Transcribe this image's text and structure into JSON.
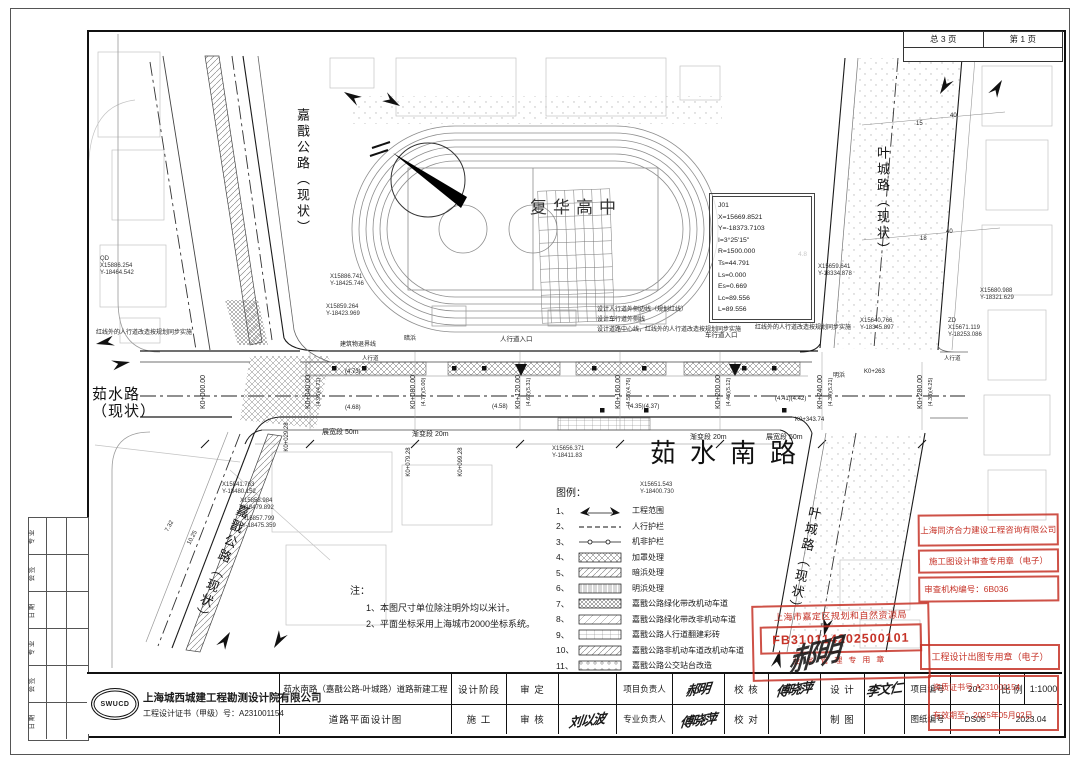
{
  "colors": {
    "stamp_red": "#c63227",
    "line_dark": "#1b1b1b"
  },
  "page": {
    "sheet_total": "总 3 页",
    "sheet_no": "第 1 页"
  },
  "roads": {
    "main": "茹水南路",
    "school": "复华高中",
    "jiajian": "嘉戬公路（现状）",
    "yecheng": "叶城路（现状）",
    "rushui_line1": "茹水路",
    "rushui_line2": "（现状）"
  },
  "curve_box": {
    "lines": [
      "J01",
      "X=15669.8521",
      "Y=-18373.7103",
      "I=3°25'15\"",
      "R=1500.000",
      "Ts=44.791",
      "Ls=0.000",
      "Es=0.669",
      "Lc=89.556",
      "L=89.556"
    ]
  },
  "stations": [
    {
      "label": "K0+000.00",
      "elev": ""
    },
    {
      "label": "K0+040.00",
      "elev": "(4.96)(4.71)"
    },
    {
      "label": "K0+080.00",
      "elev": "(4.77)(5.00)"
    },
    {
      "label": "K0+120.00",
      "elev": "(4.62)(5.31)"
    },
    {
      "label": "K0+160.00",
      "elev": "(4.53)(4.76)"
    },
    {
      "label": "K0+200.00",
      "elev": "(4.46)(5.12)"
    },
    {
      "label": "K0+240.00",
      "elev": "(4.39)(5.21)"
    },
    {
      "label": "K0+280.00",
      "elev": "(4.33)(4.25)"
    }
  ],
  "substations": [
    {
      "label": "K0+029.28"
    },
    {
      "label": "K0+079.28"
    },
    {
      "label": "K0+099.28"
    }
  ],
  "coords": [
    {
      "lines": [
        "QD",
        "X15886.254",
        "Y-18464.542"
      ]
    },
    {
      "lines": [
        "X15886.741",
        "Y-18425.746"
      ]
    },
    {
      "lines": [
        "X15859.264",
        "Y-18423.969"
      ]
    },
    {
      "lines": [
        "X15659.641",
        "Y-18334.878"
      ]
    },
    {
      "lines": [
        "X15640.766",
        "Y-18345.897"
      ]
    },
    {
      "lines": [
        "X15680.988",
        "Y-18321.629"
      ]
    },
    {
      "lines": [
        "ZD",
        "X15671.119",
        "Y-18253.086"
      ]
    },
    {
      "lines": [
        "X15841.763",
        "Y-18480.152"
      ]
    },
    {
      "lines": [
        "X15858.984",
        "Y-18479.892"
      ]
    },
    {
      "lines": [
        "X15857.799",
        "Y-18475.359"
      ]
    },
    {
      "lines": [
        "X15656.371",
        "Y-18411.83"
      ]
    },
    {
      "lines": [
        "X15651.543",
        "Y-18400.730"
      ]
    }
  ],
  "ann": [
    {
      "t": "建筑物退界线"
    },
    {
      "t": "暗浜"
    },
    {
      "t": "明浜"
    },
    {
      "t": "人行道入口"
    },
    {
      "t": "车行道入口"
    },
    {
      "t": "设计人行道外侧边线（规划红线）"
    },
    {
      "t": "设计车行道外侧线"
    },
    {
      "t": "设计道路中心线，红线外的人行道改造按规划同步实施"
    },
    {
      "t": "红线外的人行道改造按规划同步实施"
    },
    {
      "t": "红线外的人行道改造按规划同步实施"
    },
    {
      "t": "人行道"
    },
    {
      "t": "人行道"
    },
    {
      "t": "展宽段 50m"
    },
    {
      "t": "渐变段 20m"
    },
    {
      "t": "渐变段 20m"
    },
    {
      "t": "展宽段 50m"
    },
    {
      "t": "4.8"
    },
    {
      "t": "7.32"
    },
    {
      "t": "10.25"
    },
    {
      "t": "40"
    },
    {
      "t": "15"
    },
    {
      "t": "40"
    },
    {
      "t": "18"
    },
    {
      "t": "K0+343.74"
    },
    {
      "t": "K0+263"
    },
    {
      "t": "(4.73)"
    },
    {
      "t": "(4.68)"
    },
    {
      "t": "(4.58)"
    },
    {
      "t": "(4.41)(4.42)"
    },
    {
      "t": "(4.35)(4.37)"
    }
  ],
  "legend": {
    "title": "图例：",
    "items": [
      {
        "no": "1、",
        "label": "工程范围"
      },
      {
        "no": "2、",
        "label": "人行护栏"
      },
      {
        "no": "3、",
        "label": "机非护栏"
      },
      {
        "no": "4、",
        "label": "加罩处理"
      },
      {
        "no": "5、",
        "label": "暗浜处理"
      },
      {
        "no": "6、",
        "label": "明浜处理"
      },
      {
        "no": "7、",
        "label": "嘉戬公路绿化带改机动车道"
      },
      {
        "no": "8、",
        "label": "嘉戬公路绿化带改非机动车道"
      },
      {
        "no": "9、",
        "label": "嘉戬公路人行道翻建彩砖"
      },
      {
        "no": "10、",
        "label": "嘉戬公路非机动车道改机动车道"
      },
      {
        "no": "11、",
        "label": "嘉戬公路公交站台改造"
      }
    ]
  },
  "notes": {
    "title": "注：",
    "lines": [
      "1、本图尺寸单位除注明外均以米计。",
      "2、平面坐标采用上海城市2000坐标系统。"
    ]
  },
  "signoff": {
    "rows": [
      "专 业",
      "会 签",
      "日 期",
      "专 业",
      "会 签",
      "日 期"
    ]
  },
  "stamps": {
    "review": {
      "company": "上海同济合力建设工程咨询有限公司",
      "seal": "施工图设计审查专用章（电子）",
      "number": "审查机构编号：6B036"
    },
    "bureau": {
      "name": "上海市嘉定区规划和自然资源局",
      "number": "FB310114202500101",
      "bottom": "业务管理专用章"
    },
    "output": {
      "text": "工程设计出图专用章（电子）"
    },
    "cert": {
      "line1": "资质证书号 A231001154",
      "line2": "有效期至：2025年05月02日"
    }
  },
  "titleblock": {
    "company": {
      "name": "上海城西城建工程勘测设计院有限公司",
      "cert": "工程设计证书（甲级）号：A231001154",
      "logo": "SWUCD"
    },
    "project": {
      "name": "茹水南路（嘉戬公路-叶城路）道路新建工程",
      "drawing": "道路平面设计图"
    },
    "cells": {
      "stage_label": "设计阶段",
      "stage_value": "施  工",
      "shending": "审  定",
      "shenhe": "审  核",
      "xmfzr": "项目负责人",
      "zyfzr": "专业负责人",
      "xiaohe": "校  核",
      "xiaodui": "校  对",
      "sheji": "设  计",
      "zhitu": "制  图",
      "xmbh": "项目编号",
      "tzbh": "图纸编号",
      "bili": "比 例",
      "xmbh_value": "201",
      "tzbh_value": "DS05",
      "bili_value": "1:1000",
      "date_value": "2023.04"
    },
    "signatures": {
      "shenhe": "刘以波",
      "xmfzr": "郝明",
      "xiaohe": "傅晓萍",
      "zyfzr": "傅晓萍",
      "sheji": "李文仁",
      "stamp_sig": "郝明"
    }
  }
}
